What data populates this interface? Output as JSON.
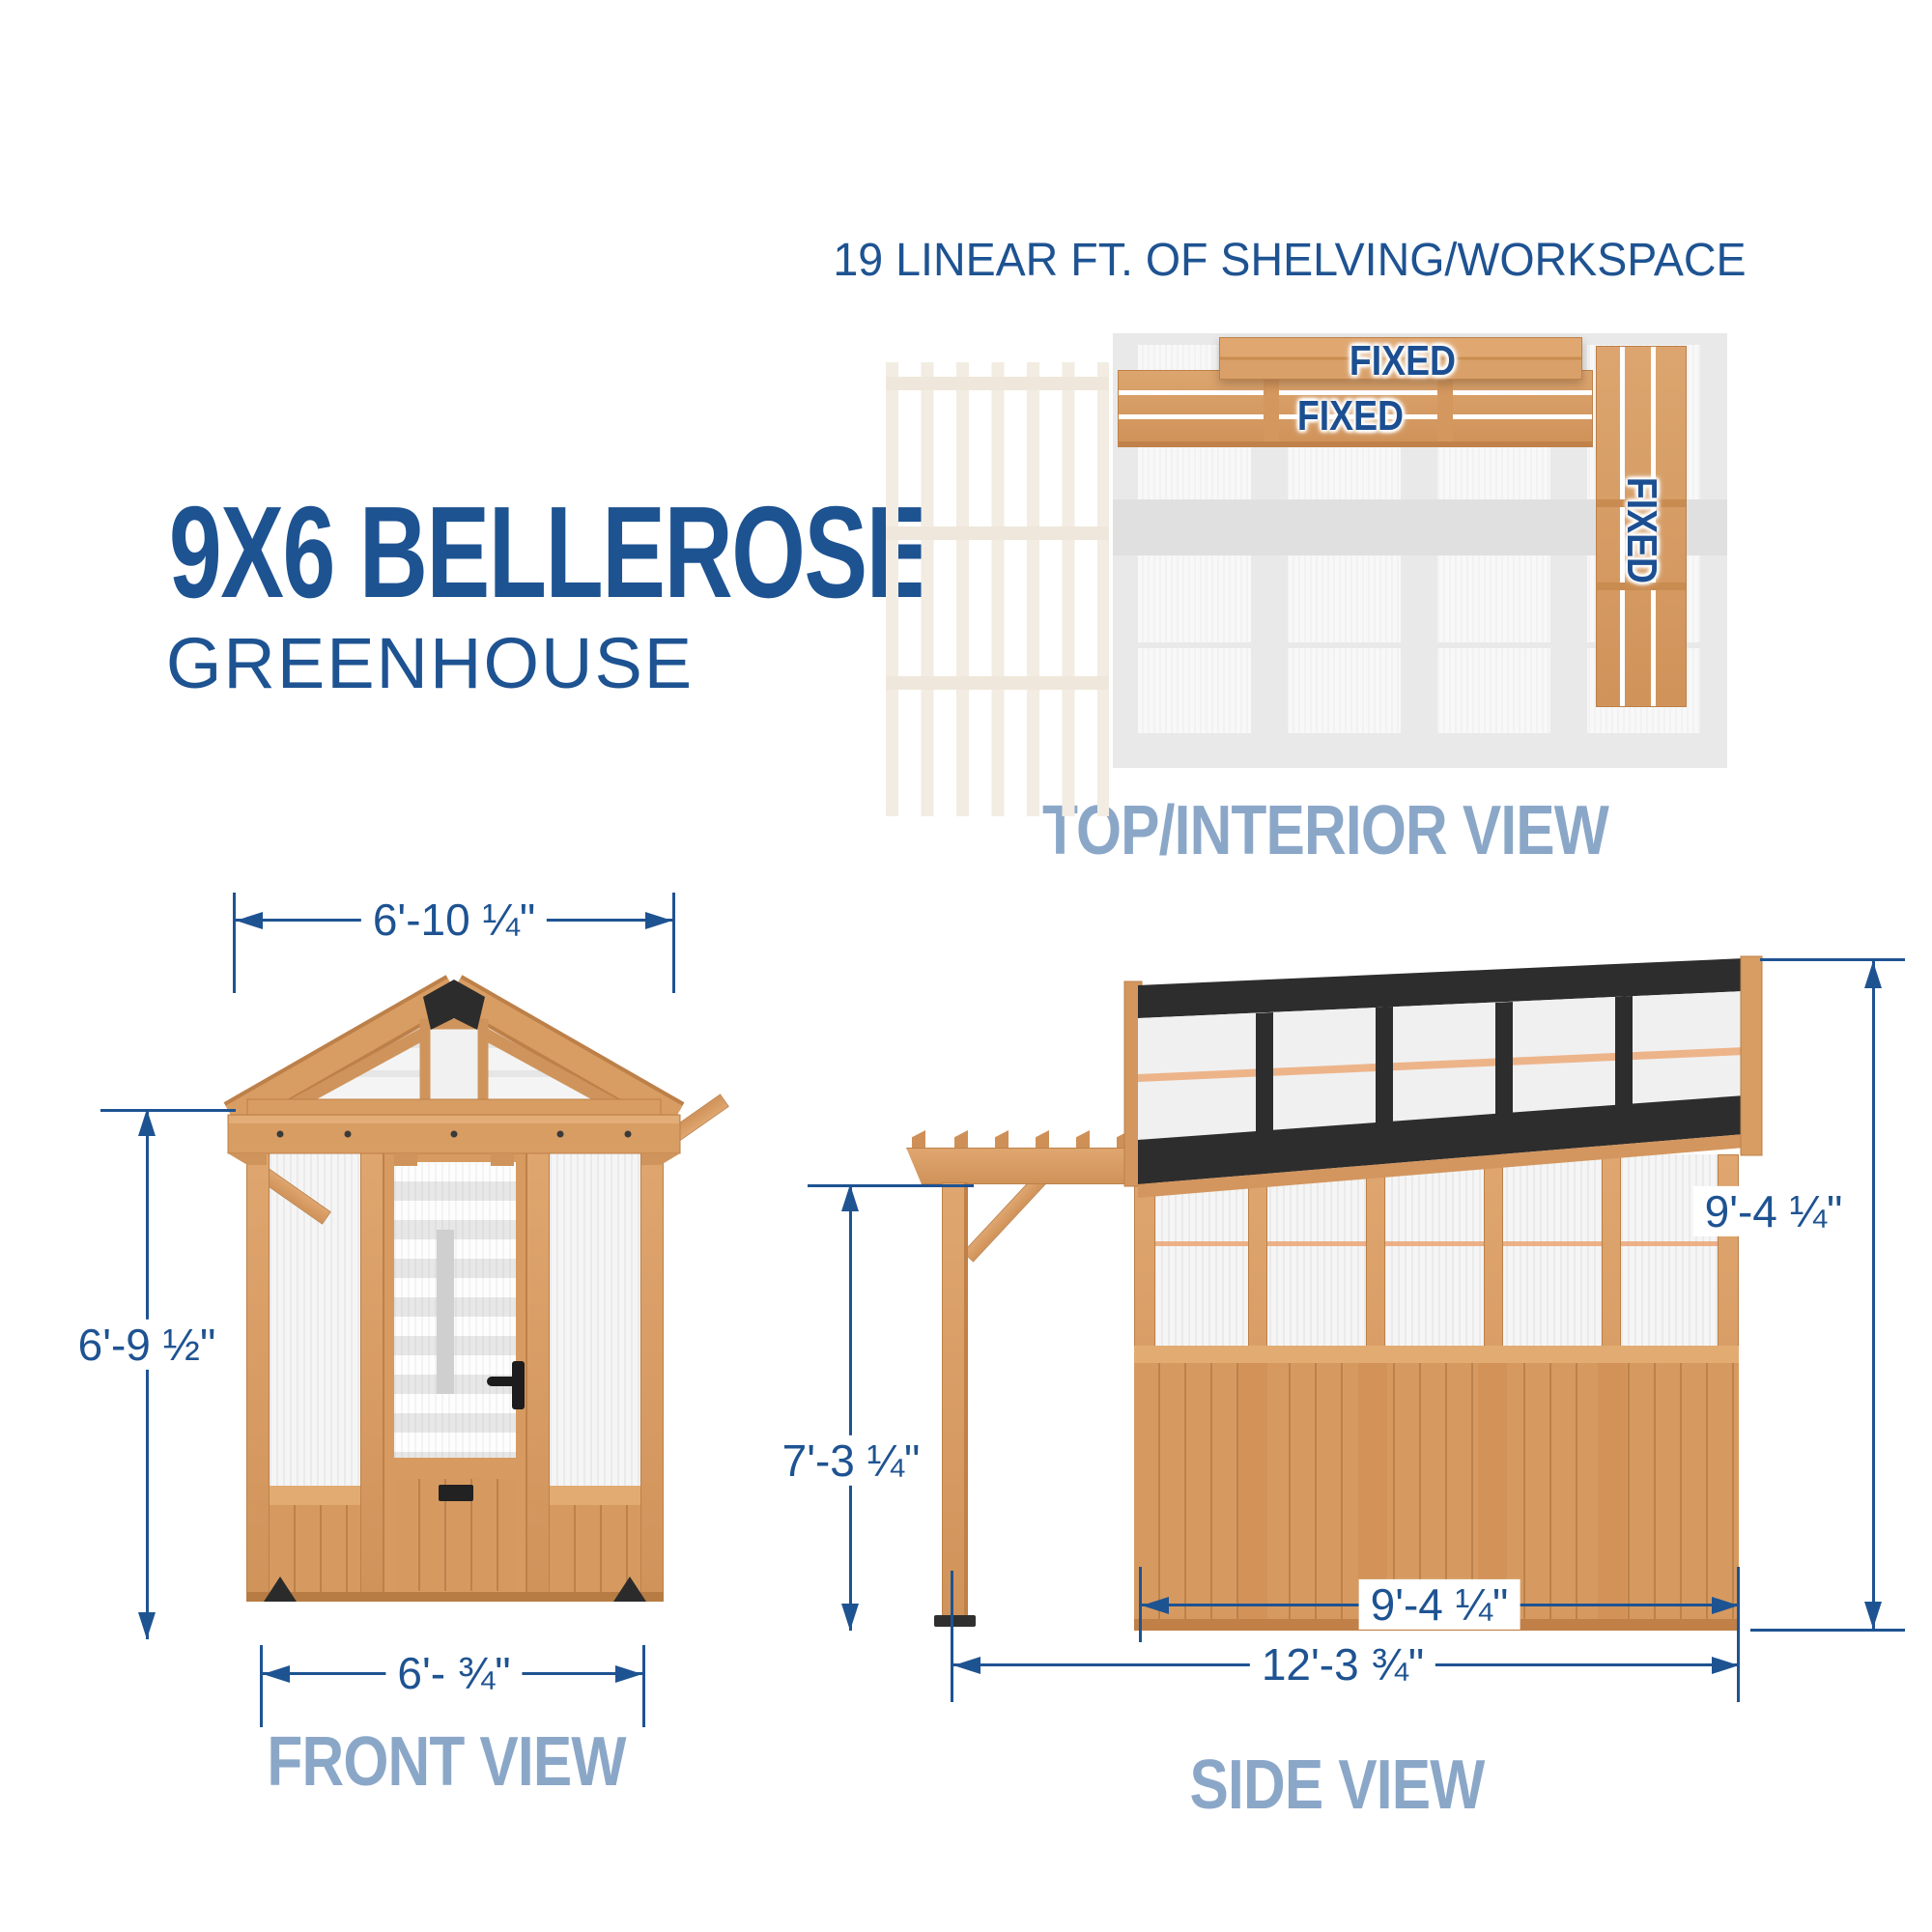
{
  "colors": {
    "accent_blue": "#1e5392",
    "caption_blue": "#8ba7c8",
    "wood": "#d79b61",
    "frame_black": "#2d2d2d",
    "faded_pergola": "#f2ece2"
  },
  "title": {
    "model": "9X6 BELLEROSE",
    "product": "GREENHOUSE"
  },
  "top_view": {
    "heading": "19 LINEAR FT. OF SHELVING/WORKSPACE",
    "caption": "TOP/INTERIOR VIEW",
    "labels": {
      "shelf_back_upper": "FIXED",
      "shelf_back_lower": "FIXED",
      "shelf_side": "FIXED"
    }
  },
  "front_view": {
    "caption": "FRONT VIEW",
    "dimensions": {
      "roof_width": "6'-10 ¼\"",
      "wall_height": "6'-9 ½\"",
      "base_width": "6'- ¾\""
    }
  },
  "side_view": {
    "caption": "SIDE VIEW",
    "dimensions": {
      "pergola_height": "7'-3 ¼\"",
      "overall_height": "9'-4 ¼\"",
      "greenhouse_depth": "9'-4 ¼\"",
      "overall_depth": "12'-3 ¾\""
    }
  }
}
